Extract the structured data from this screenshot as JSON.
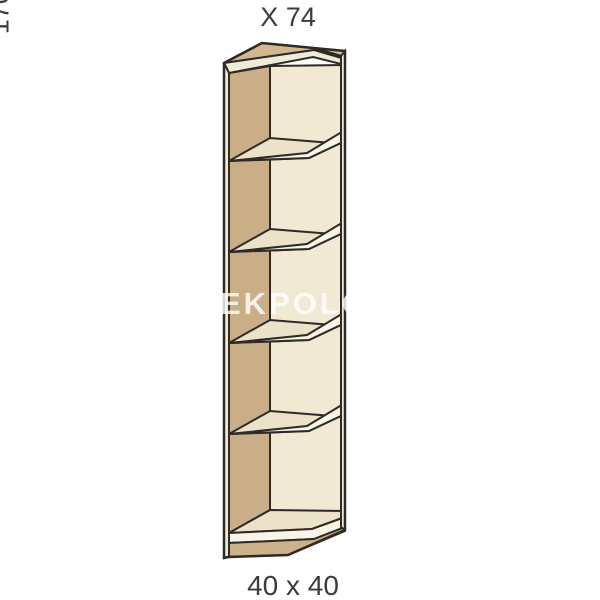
{
  "page": {
    "background": "#ffffff"
  },
  "drawing": {
    "type": "corner-open-shelf-unit",
    "compartments": 5,
    "labels": {
      "top_label": "X 74",
      "right_label": "170.4",
      "bottom_label": "40 x 40"
    },
    "watermark": "EKPOLO",
    "colors": {
      "outline": "#2e2a25",
      "top_panel": "#d3b88f",
      "side_panel": "#c9ae88",
      "back_panel": "#f2e9d5",
      "shelf_top": "#ece1c9",
      "shelf_edge": "#f9f4e8",
      "edge_band": "#f0ead8",
      "plinth": "#ccb28a",
      "label_text": "#3c3c3c",
      "watermark_color": "rgba(255,255,255,0.8)"
    }
  }
}
